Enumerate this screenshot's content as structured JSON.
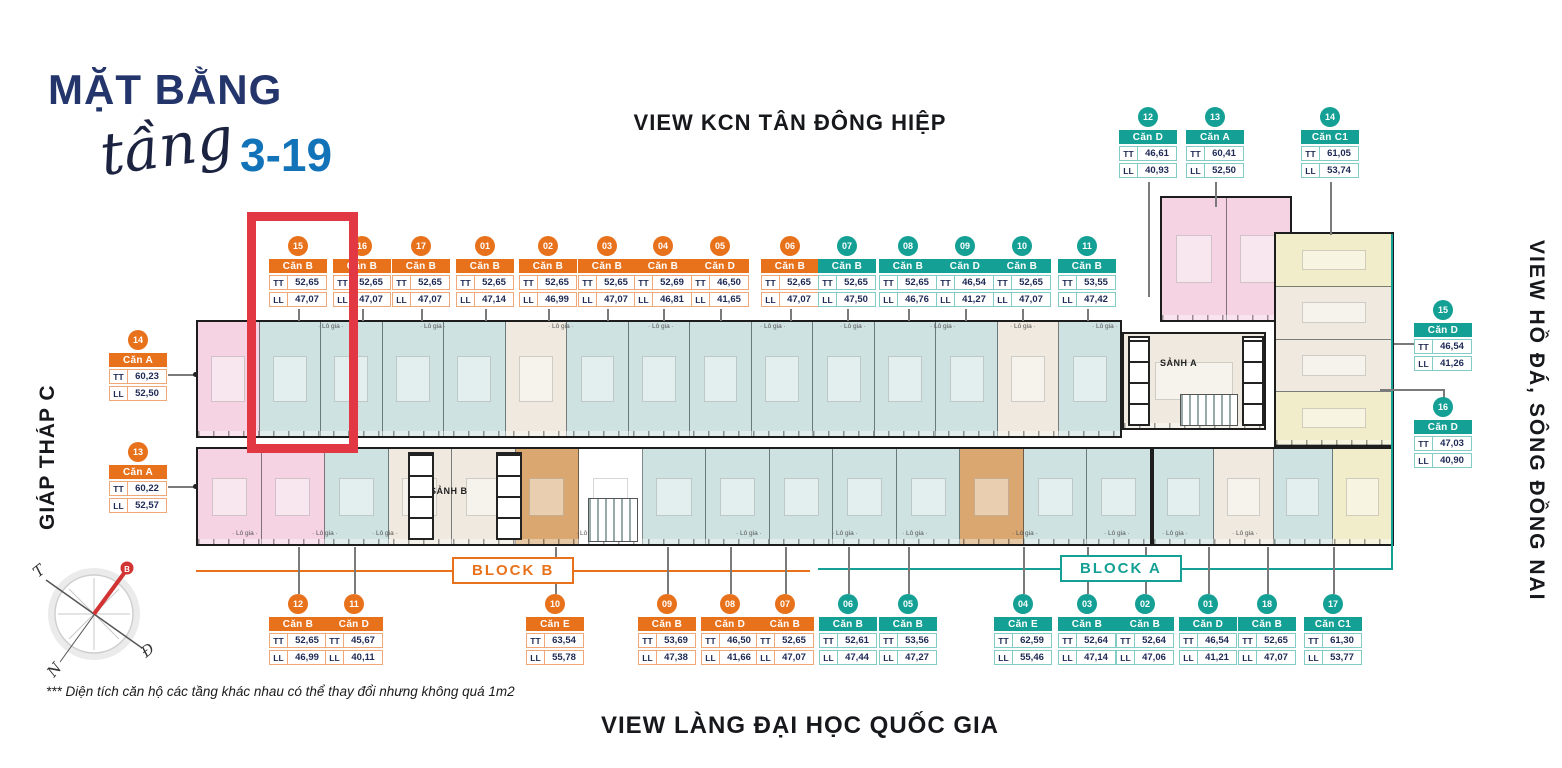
{
  "title": {
    "main": "MẶT BẰNG",
    "script": "tầng",
    "range": "3-19"
  },
  "views": {
    "top": "VIEW KCN TÂN ĐÔNG HIỆP",
    "bottom": "VIEW LÀNG ĐẠI HỌC QUỐC GIA",
    "right": "VIEW HỒ ĐÁ, SÔNG ĐỒNG NAI",
    "left": "GIÁP THÁP C"
  },
  "blocks": {
    "block_b": "BLOCK B",
    "block_a": "BLOCK A"
  },
  "footnote": "*** Diện tích căn hộ các tầng khác nhau có thể thay đổi nhưng không quá 1m2",
  "keys": {
    "tt": "TT",
    "ll": "LL"
  },
  "plan_labels": {
    "lobby_a": "SẢNH A",
    "lobby_b": "SẢNH B",
    "logia": "Lô gia"
  },
  "compass": {
    "north": "B",
    "south": "N",
    "east": "Đ",
    "west": "T"
  },
  "colors": {
    "accent_orange": "#E8721C",
    "accent_teal": "#14A095",
    "navy": "#23356B",
    "blue": "#1273B8",
    "highlight_red": "#E23844",
    "unit_teal": "#cde2e1",
    "unit_pink": "#f5d3e2",
    "unit_tan": "#d9a76f",
    "unit_cream": "#efe9df",
    "unit_yellow": "#f1ecca"
  },
  "highlight": {
    "unit": "15"
  },
  "unit_labels": {
    "top_row": [
      {
        "num": "15",
        "type": "Căn B",
        "tt": "52,65",
        "ll": "47,07",
        "theme": "orange",
        "x": 298
      },
      {
        "num": "16",
        "type": "Căn B",
        "tt": "52,65",
        "ll": "47,07",
        "theme": "orange",
        "x": 362
      },
      {
        "num": "17",
        "type": "Căn B",
        "tt": "52,65",
        "ll": "47,07",
        "theme": "orange",
        "x": 421
      },
      {
        "num": "01",
        "type": "Căn B",
        "tt": "52,65",
        "ll": "47,14",
        "theme": "orange",
        "x": 485
      },
      {
        "num": "02",
        "type": "Căn B",
        "tt": "52,65",
        "ll": "46,99",
        "theme": "orange",
        "x": 548
      },
      {
        "num": "03",
        "type": "Căn B",
        "tt": "52,65",
        "ll": "47,07",
        "theme": "orange",
        "x": 607
      },
      {
        "num": "04",
        "type": "Căn B",
        "tt": "52,69",
        "ll": "46,81",
        "theme": "orange",
        "x": 663
      },
      {
        "num": "05",
        "type": "Căn D",
        "tt": "46,50",
        "ll": "41,65",
        "theme": "orange",
        "x": 720
      },
      {
        "num": "06",
        "type": "Căn B",
        "tt": "52,65",
        "ll": "47,07",
        "theme": "orange",
        "x": 790
      },
      {
        "num": "07",
        "type": "Căn B",
        "tt": "52,65",
        "ll": "47,50",
        "theme": "teal",
        "x": 847
      },
      {
        "num": "08",
        "type": "Căn B",
        "tt": "52,65",
        "ll": "46,76",
        "theme": "teal",
        "x": 908
      },
      {
        "num": "09",
        "type": "Căn D",
        "tt": "46,54",
        "ll": "41,27",
        "theme": "teal",
        "x": 965
      },
      {
        "num": "10",
        "type": "Căn B",
        "tt": "52,65",
        "ll": "47,07",
        "theme": "teal",
        "x": 1022
      },
      {
        "num": "11",
        "type": "Căn B",
        "tt": "53,55",
        "ll": "47,42",
        "theme": "teal",
        "x": 1087
      }
    ],
    "top_right": [
      {
        "num": "12",
        "type": "Căn D",
        "tt": "46,61",
        "ll": "40,93",
        "theme": "teal",
        "x": 1148
      },
      {
        "num": "13",
        "type": "Căn A",
        "tt": "60,41",
        "ll": "52,50",
        "theme": "teal",
        "x": 1215
      },
      {
        "num": "14",
        "type": "Căn C1",
        "tt": "61,05",
        "ll": "53,74",
        "theme": "teal",
        "x": 1330
      }
    ],
    "right_col": [
      {
        "num": "15",
        "type": "Căn D",
        "tt": "46,54",
        "ll": "41,26",
        "theme": "teal",
        "x": 1443,
        "top": 300
      },
      {
        "num": "16",
        "type": "Căn D",
        "tt": "47,03",
        "ll": "40,90",
        "theme": "teal",
        "x": 1443,
        "top": 397
      }
    ],
    "left_col": [
      {
        "num": "14",
        "type": "Căn A",
        "tt": "60,23",
        "ll": "52,50",
        "theme": "orange",
        "x": 138,
        "top": 330
      },
      {
        "num": "13",
        "type": "Căn A",
        "tt": "60,22",
        "ll": "52,57",
        "theme": "orange",
        "x": 138,
        "top": 442
      }
    ],
    "bottom_row": [
      {
        "num": "12",
        "type": "Căn B",
        "tt": "52,65",
        "ll": "46,99",
        "theme": "orange",
        "x": 298
      },
      {
        "num": "11",
        "type": "Căn D",
        "tt": "45,67",
        "ll": "40,11",
        "theme": "orange",
        "x": 354
      },
      {
        "num": "10",
        "type": "Căn E",
        "tt": "63,54",
        "ll": "55,78",
        "theme": "orange",
        "x": 555
      },
      {
        "num": "09",
        "type": "Căn B",
        "tt": "53,69",
        "ll": "47,38",
        "theme": "orange",
        "x": 667
      },
      {
        "num": "08",
        "type": "Căn D",
        "tt": "46,50",
        "ll": "41,66",
        "theme": "orange",
        "x": 730
      },
      {
        "num": "07",
        "type": "Căn B",
        "tt": "52,65",
        "ll": "47,07",
        "theme": "orange",
        "x": 785
      },
      {
        "num": "06",
        "type": "Căn B",
        "tt": "52,61",
        "ll": "47,44",
        "theme": "teal",
        "x": 848
      },
      {
        "num": "05",
        "type": "Căn B",
        "tt": "53,56",
        "ll": "47,27",
        "theme": "teal",
        "x": 908
      },
      {
        "num": "04",
        "type": "Căn E",
        "tt": "62,59",
        "ll": "55,46",
        "theme": "teal",
        "x": 1023
      },
      {
        "num": "03",
        "type": "Căn B",
        "tt": "52,64",
        "ll": "47,14",
        "theme": "teal",
        "x": 1087
      },
      {
        "num": "02",
        "type": "Căn B",
        "tt": "52,64",
        "ll": "47,06",
        "theme": "teal",
        "x": 1145
      },
      {
        "num": "01",
        "type": "Căn D",
        "tt": "46,54",
        "ll": "41,21",
        "theme": "teal",
        "x": 1208
      },
      {
        "num": "18",
        "type": "Căn B",
        "tt": "52,65",
        "ll": "47,07",
        "theme": "teal",
        "x": 1267
      },
      {
        "num": "17",
        "type": "Căn C1",
        "tt": "61,30",
        "ll": "53,77",
        "theme": "teal",
        "x": 1333
      }
    ]
  },
  "plan": {
    "top_band": {
      "x": 196,
      "y": 320,
      "w": 926,
      "h": 118,
      "cells": [
        "pink",
        "teal",
        "teal",
        "teal",
        "teal",
        "cream",
        "teal",
        "teal",
        "teal",
        "teal",
        "teal",
        "teal",
        "teal",
        "cream",
        "teal"
      ]
    },
    "bottom_band": {
      "x": 196,
      "y": 447,
      "w": 956,
      "h": 99,
      "cells": [
        "pink",
        "pink",
        "teal",
        "cream",
        "cream",
        "tan",
        "white",
        "teal",
        "teal",
        "teal",
        "teal",
        "teal",
        "tan",
        "teal",
        "teal"
      ]
    },
    "bottom_right_band": {
      "x": 1152,
      "y": 447,
      "w": 242,
      "h": 99,
      "cells": [
        "teal",
        "cream",
        "teal",
        "yellow"
      ]
    },
    "pink_block": {
      "x": 1160,
      "y": 196,
      "w": 132,
      "h": 126,
      "cells": [
        "pink",
        "pink"
      ]
    },
    "lobby_a": {
      "x": 1122,
      "y": 332,
      "w": 144,
      "h": 98,
      "cells": [
        "cream"
      ]
    },
    "right_tower": {
      "x": 1274,
      "y": 232,
      "w": 120,
      "h": 215,
      "vertical": true,
      "cells": [
        "yellow",
        "cream",
        "cream",
        "yellow"
      ]
    },
    "logia_top_positions": [
      318,
      420,
      548,
      648,
      760,
      840,
      930,
      1010,
      1092
    ],
    "logia_bottom_positions": [
      232,
      312,
      372,
      576,
      736,
      832,
      902,
      1012,
      1104,
      1162,
      1232
    ]
  }
}
